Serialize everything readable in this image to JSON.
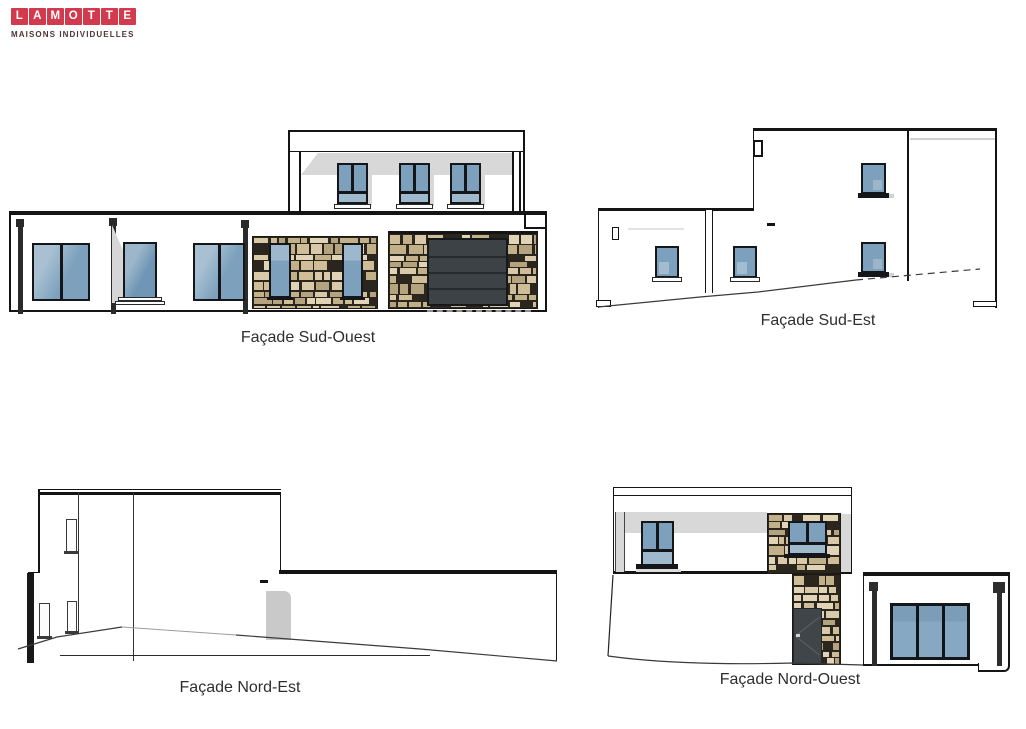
{
  "page": {
    "background": "#ffffff"
  },
  "logo": {
    "letters": [
      "L",
      "A",
      "M",
      "O",
      "T",
      "T",
      "E"
    ],
    "subtitle": "MAISONS INDIVIDUELLES",
    "tile_color": "#d23b4e",
    "letter_color": "#ffffff",
    "subtitle_color": "#4d3439"
  },
  "facades": {
    "sud_ouest": {
      "label": "Façade Sud-Ouest"
    },
    "sud_est": {
      "label": "Façade Sud-Est"
    },
    "nord_est": {
      "label": "Façade Nord-Est"
    },
    "nord_ouest": {
      "label": "Façade Nord-Ouest"
    }
  },
  "colors": {
    "line": "#141414",
    "window_frame": "#14161a",
    "glass": "#7da1bd",
    "glass_light": "#9fb9cd",
    "shadow_gray": "#d8d8d8",
    "stone_joint": "#2a261d",
    "stone_tans": [
      "#d9c9a8",
      "#cfbd98",
      "#c2b089",
      "#e1d4b6",
      "#b5a37f"
    ],
    "garage_door": "#3c4245",
    "entry_door": "#3f4548",
    "side_door_gray": "#c9c9c9"
  }
}
